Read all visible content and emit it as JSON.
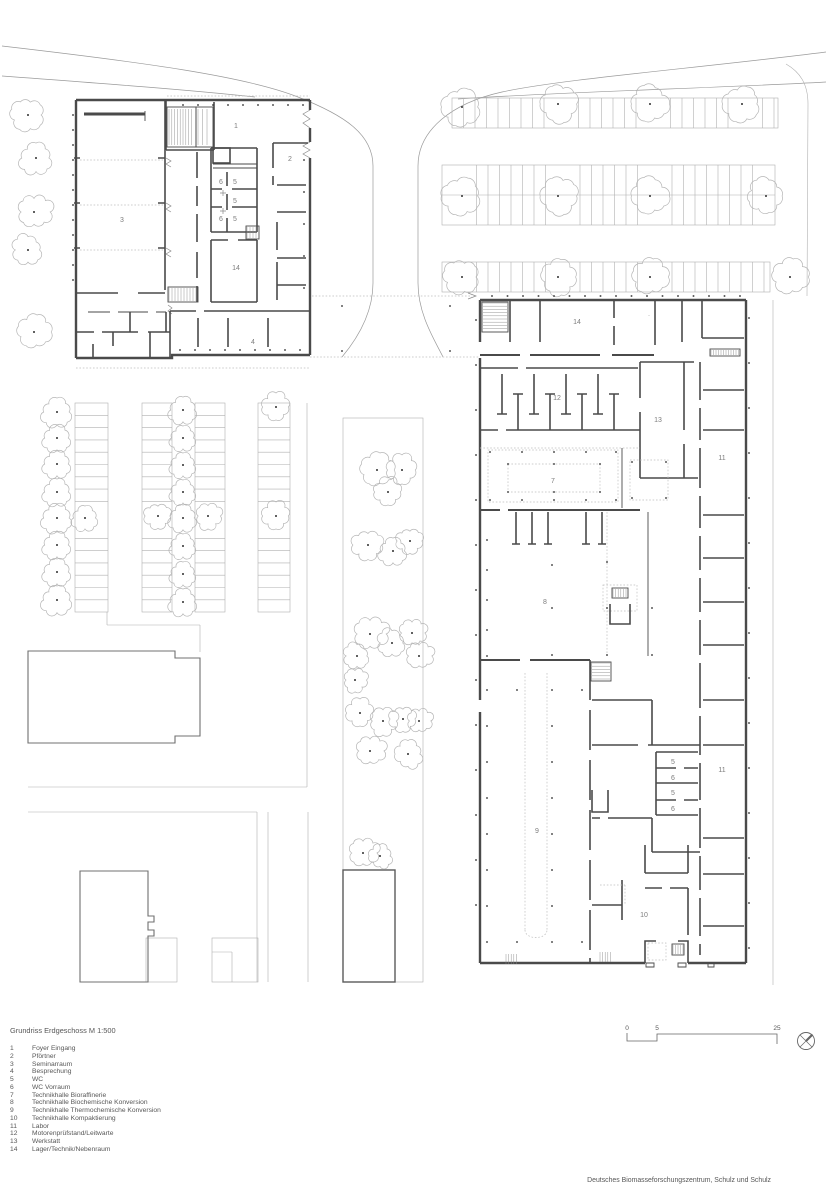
{
  "sheet": {
    "background": "#ffffff"
  },
  "title_block": {
    "title": "Grundriss Erdgeschoss M 1:500"
  },
  "legend": {
    "items": [
      {
        "num": "1",
        "label": "Foyer Eingang"
      },
      {
        "num": "2",
        "label": "Pförtner"
      },
      {
        "num": "3",
        "label": "Seminarraum"
      },
      {
        "num": "4",
        "label": "Besprechung"
      },
      {
        "num": "5",
        "label": "WC"
      },
      {
        "num": "6",
        "label": "WC Vorraum"
      },
      {
        "num": "7",
        "label": "Technikhalle Bioraffinerie"
      },
      {
        "num": "8",
        "label": "Technikhalle Biochemische Konversion"
      },
      {
        "num": "9",
        "label": "Technikhalle Thermochemische Konversion"
      },
      {
        "num": "10",
        "label": "Technikhalle Kompaktierung"
      },
      {
        "num": "11",
        "label": "Labor"
      },
      {
        "num": "12",
        "label": "Motorenprüfstand/Leitwarte"
      },
      {
        "num": "13",
        "label": "Werkstatt"
      },
      {
        "num": "14",
        "label": "Lager/Technik/Nebenraum"
      }
    ]
  },
  "plan": {
    "room_labels": [
      {
        "label": "1",
        "x": 236,
        "y": 128
      },
      {
        "label": "2",
        "x": 290,
        "y": 161
      },
      {
        "label": "6",
        "x": 221,
        "y": 184
      },
      {
        "label": "5",
        "x": 235,
        "y": 184
      },
      {
        "label": "5",
        "x": 235,
        "y": 203
      },
      {
        "label": "6",
        "x": 221,
        "y": 221
      },
      {
        "label": "5",
        "x": 235,
        "y": 221
      },
      {
        "label": "3",
        "x": 122,
        "y": 222
      },
      {
        "label": "14",
        "x": 236,
        "y": 270
      },
      {
        "label": "4",
        "x": 253,
        "y": 344
      },
      {
        "label": "14",
        "x": 577,
        "y": 324
      },
      {
        "label": "12",
        "x": 557,
        "y": 400
      },
      {
        "label": "13",
        "x": 658,
        "y": 422
      },
      {
        "label": "11",
        "x": 722,
        "y": 460
      },
      {
        "label": "7",
        "x": 553,
        "y": 483
      },
      {
        "label": "8",
        "x": 545,
        "y": 604
      },
      {
        "label": "5",
        "x": 673,
        "y": 764
      },
      {
        "label": "6",
        "x": 673,
        "y": 780
      },
      {
        "label": "5",
        "x": 673,
        "y": 795
      },
      {
        "label": "6",
        "x": 673,
        "y": 811
      },
      {
        "label": "11",
        "x": 722,
        "y": 772
      },
      {
        "label": "9",
        "x": 537,
        "y": 833
      },
      {
        "label": "10",
        "x": 644,
        "y": 917
      }
    ]
  },
  "scale_bar": {
    "ticks": [
      "0",
      "5",
      "25"
    ]
  },
  "north_arrow": {
    "icon": "north-arrow-icon"
  },
  "caption": {
    "text": "Deutsches Biomasseforschungszentrum, Schulz und Schulz"
  },
  "colors": {
    "wall": "#4a4a4a",
    "site_line": "#9a9a9a",
    "light_line": "#b0b0b0",
    "tree": "#b5b5b5",
    "dot": "#3d3d3d",
    "label_text": "#7d7d7d",
    "annotation_text": "#575757"
  }
}
